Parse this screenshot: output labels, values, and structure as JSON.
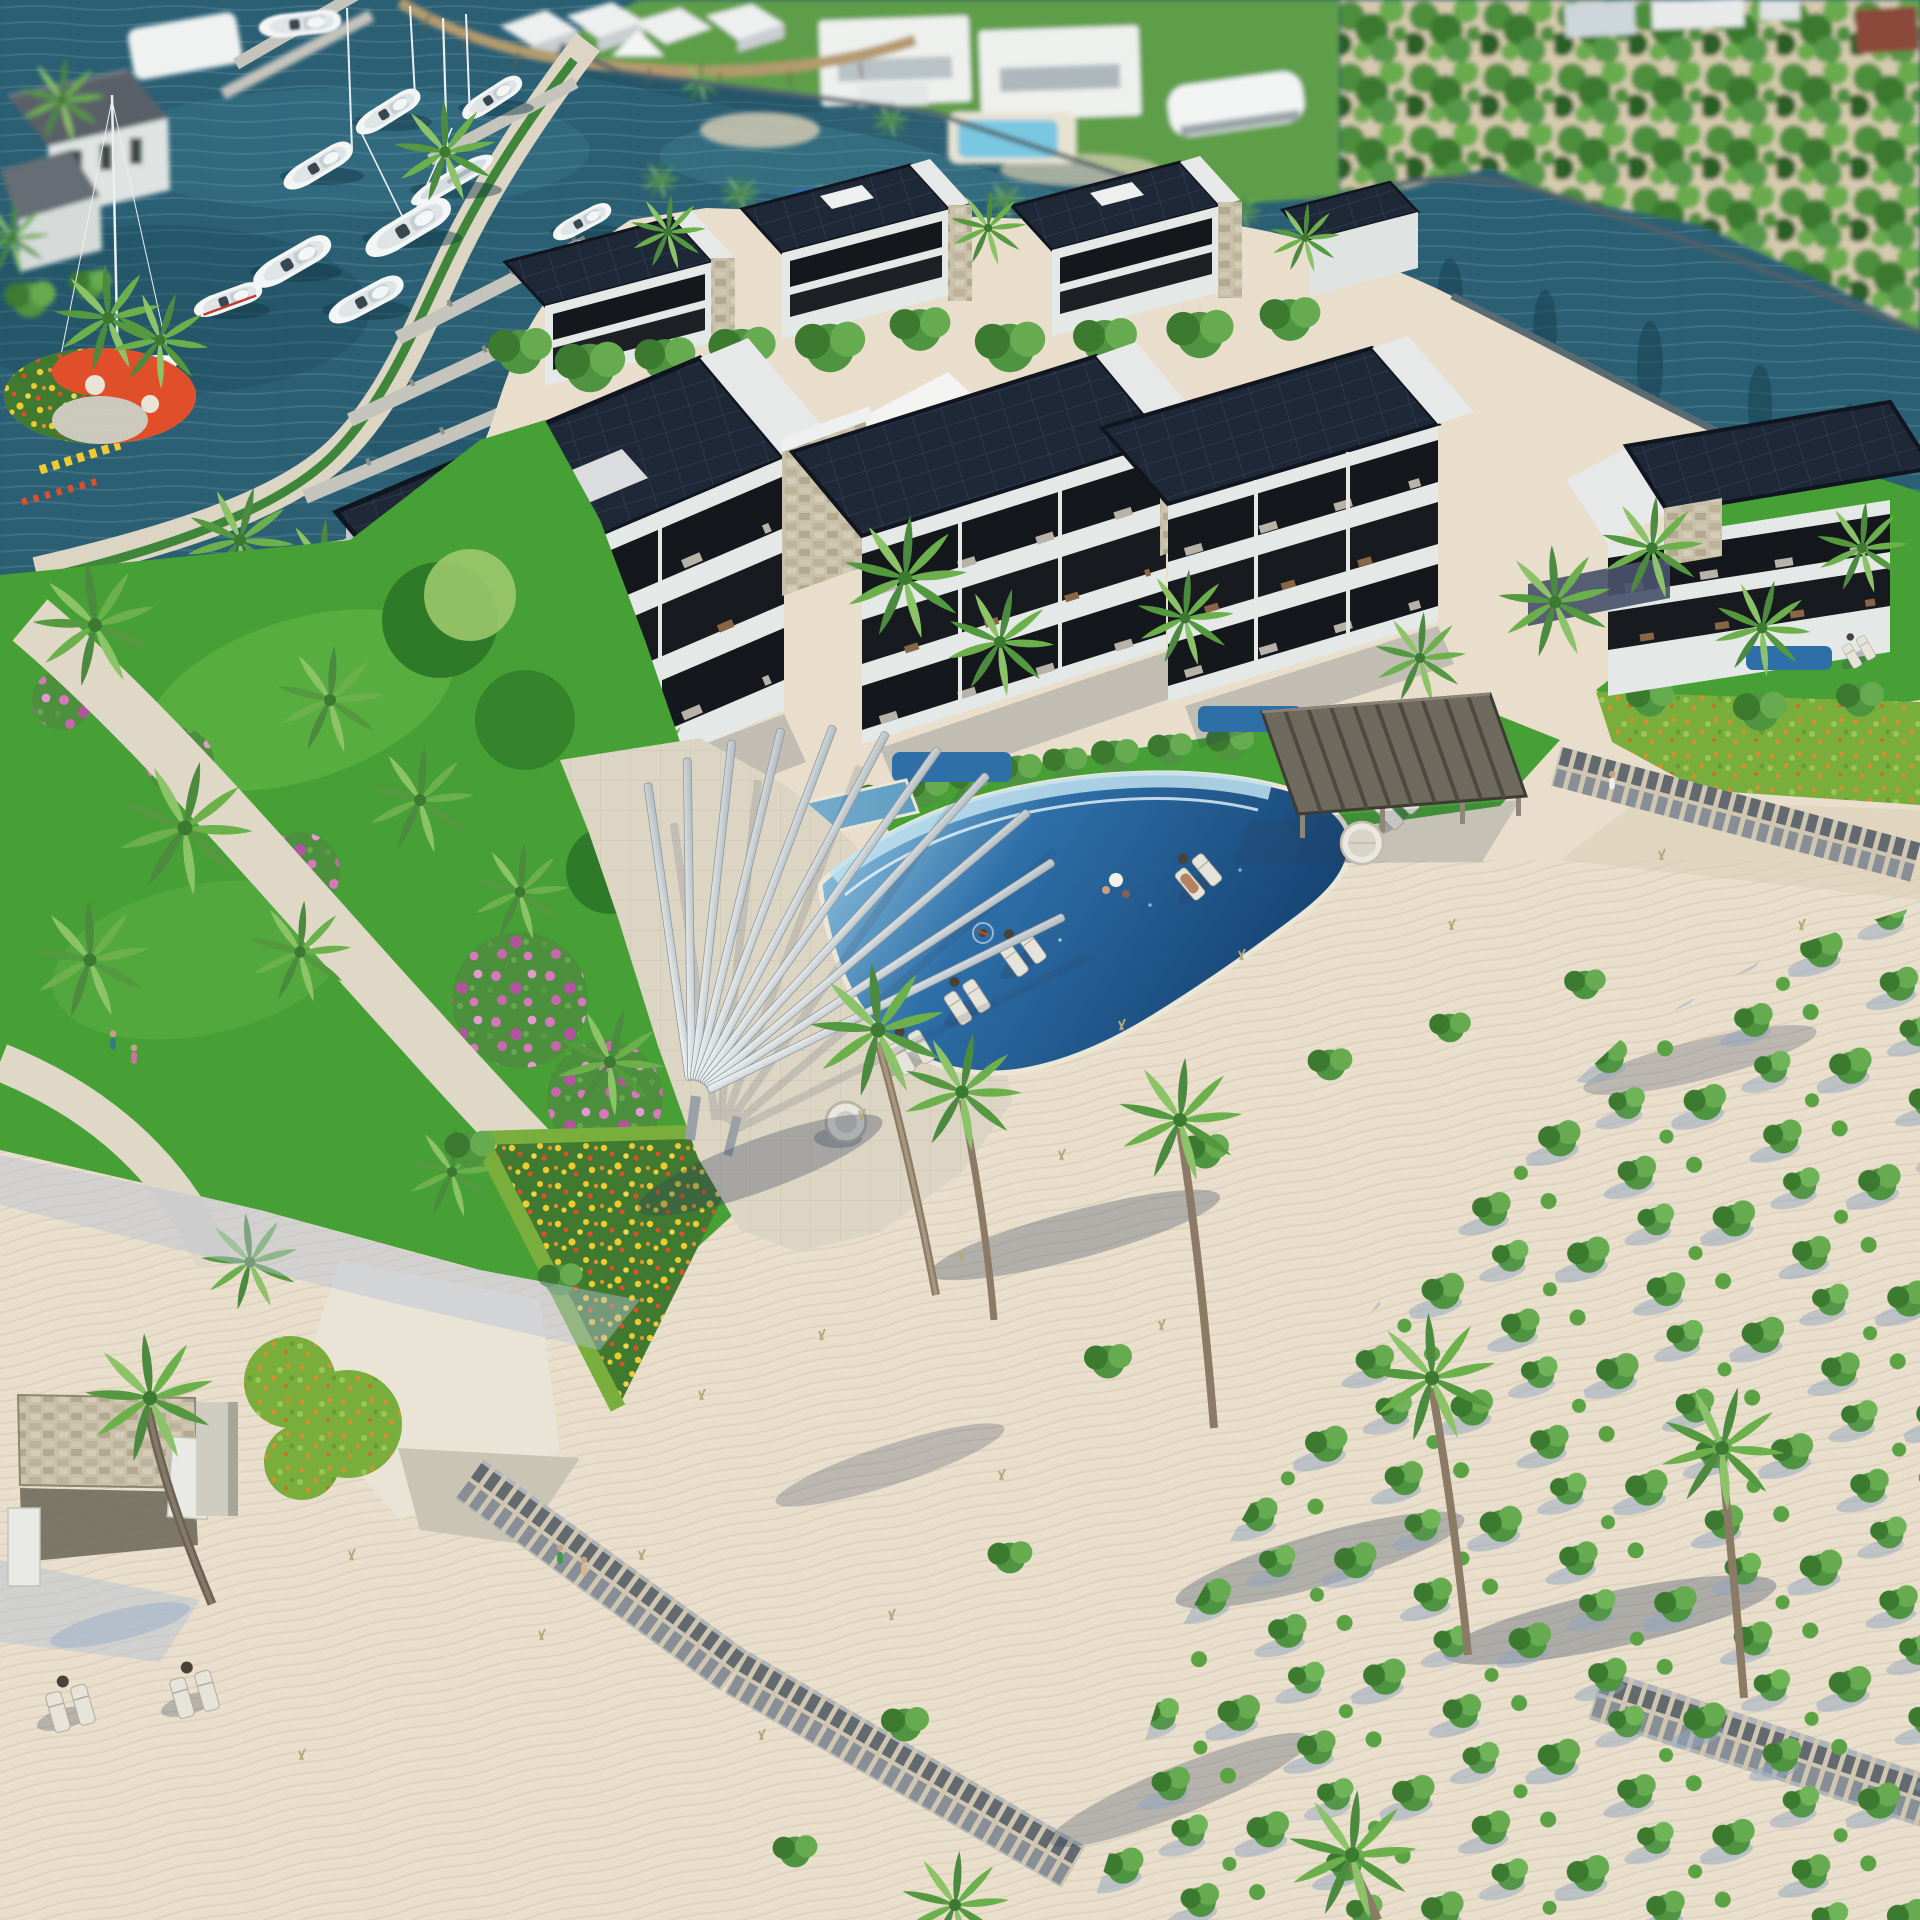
{
  "scene": {
    "type": "aerial-3d-architectural-rendering",
    "subject": "Beachfront solar-powered condominium resort with marina, lagoon pool and palm-lined white-sand beach",
    "lighting": "bright midday sun, shadows cast to the south-west",
    "camera": "high oblique aerial view, depth-of-field blur on far shore"
  },
  "palette": {
    "water": "#2a5f74",
    "water_dark": "#1c4759",
    "water_light": "#4f93a3",
    "sand": "#e8decb",
    "sand_shadow": "#b7c2d4",
    "paving": "#ddd5c3",
    "paving_light": "#e9e4d6",
    "concrete": "#cac4b4",
    "grass": "#46a035",
    "lawn_far": "#5f9e4a",
    "foliage": "#5d9f47",
    "foliage_dark": "#38762e",
    "foliage_light": "#8cc268",
    "solar_roof": "#1f2836",
    "solar_grid": "#35415c",
    "roof_edge": "#10151f",
    "ridge_white": "#e6e9e8",
    "wall": "#e4e8e6",
    "wall_shade": "#bfc9cb",
    "stone": "#c9c0aa",
    "balcony": "#14171c",
    "pool_deep": "#174a80",
    "pool_mid": "#2e6fa8",
    "pool_light": "#8fc3de",
    "pool_ledge": "#bfe0ee",
    "pergola": "#dde2e5",
    "pavilion_wood": "#6f6a5e",
    "boat": "#f4f6f6",
    "dock": "#c4c3bc",
    "pier_wood": "#b49a6e",
    "seawall": "#50616a",
    "flower_yellow": "#f0cb30",
    "flower_red": "#e04f2a",
    "flower_pink": "#d877bb",
    "flower_magenta": "#b3549f",
    "shrub_orange": "#d98e2b",
    "trunk": "#8a7a66",
    "plank": "#9fa5aa",
    "lounger": "#e6e3da",
    "shadow": "#33415e"
  },
  "inventory": {
    "marina": {
      "label": "Marina with moored white yachts",
      "boats": 12,
      "sailboat_masts": 6,
      "finger_docks": 5
    },
    "far_shore": {
      "label": "Canal-front villas and cottages",
      "villas": 2,
      "cottages": 4,
      "villa_pool": 1,
      "boat_lift": 1,
      "wooden_pier": 1
    },
    "palm_bank": {
      "label": "Dense palm-grove bank, top right",
      "buildings_glimpsed": 4
    },
    "condos_back_row": {
      "label": "Back row solar-roof condos",
      "count": 3,
      "shared_pool": 1
    },
    "condos_front_row": {
      "label": "Front row solar-roof condos",
      "count": 4,
      "balcony_levels": 3,
      "plunge_pools": 3,
      "stone_chimneys": 4,
      "tensile_canopies": 2,
      "lap_pool": 1
    },
    "pool": {
      "label": "Free-form lagoon pool",
      "swimmers": 1,
      "people_at_edge": 2,
      "lounger_pairs": 5,
      "fan_pergola_slats": 11,
      "round_planter": 1
    },
    "pavilion": {
      "label": "Timber beach pavilion",
      "beams": 9,
      "round_daybed": 1,
      "people": 2
    },
    "garden": {
      "label": "Tropical garden",
      "flower_circle_colors": [
        "yellow",
        "red"
      ],
      "flower_bed": "yellow-red triangle",
      "bougainvillea_masses": 6,
      "paths": 2,
      "people_walking": 2
    },
    "beach": {
      "label": "White-sand beach",
      "loungers": 4,
      "boardwalks": 3,
      "shrub_grove": true,
      "palms": 7,
      "beach_cabana": 1,
      "people_walking": 3
    }
  }
}
